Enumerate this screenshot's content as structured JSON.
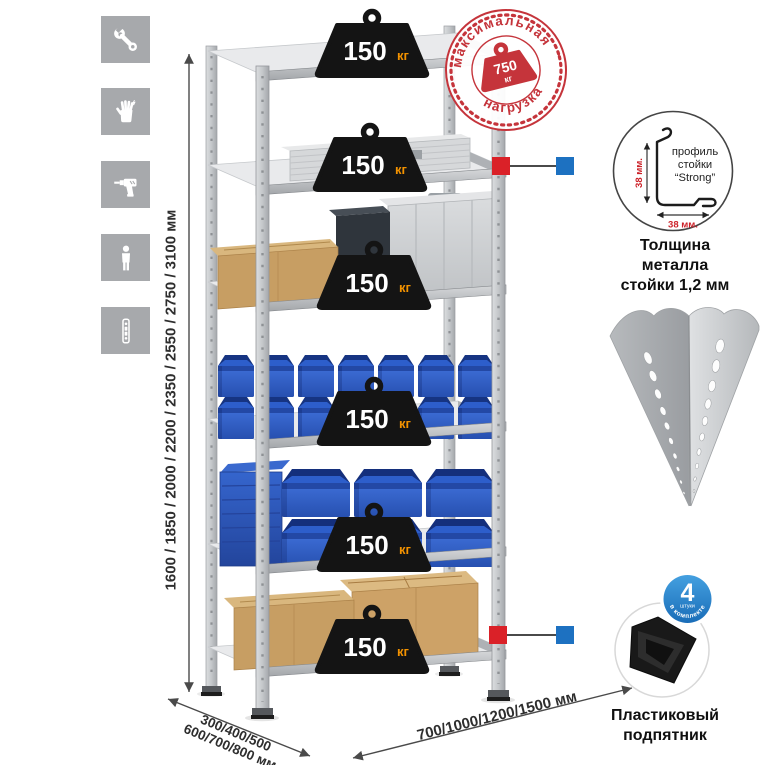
{
  "icons": {
    "items": [
      {
        "name": "wrench-icon"
      },
      {
        "name": "work-gloves-icon"
      },
      {
        "name": "power-drill-icon"
      },
      {
        "name": "assembler-person-icon"
      },
      {
        "name": "perforated-post-icon"
      }
    ]
  },
  "dimensions": {
    "height": "1600 / 1850 / 2000 / 2200 / 2350 / 2550 / 2750 / 3100 мм",
    "depth_line1": "300/400/500",
    "depth_line2": "600/700/800 мм",
    "width": "700/1000/1200/1500 мм"
  },
  "shelves": [
    {
      "load": "150",
      "unit": "кг"
    },
    {
      "load": "150",
      "unit": "кг"
    },
    {
      "load": "150",
      "unit": "кг"
    },
    {
      "load": "150",
      "unit": "кг"
    },
    {
      "load": "150",
      "unit": "кг"
    },
    {
      "load": "150",
      "unit": "кг"
    }
  ],
  "stamp": {
    "arc_top": "максимальная",
    "arc_bottom": "нагрузка",
    "value": "750",
    "unit": "кг"
  },
  "profile_detail": {
    "label_line1": "профиль",
    "label_line2": "стойки",
    "label_line3": "“Strong”",
    "dim_vertical": "38 мм.",
    "dim_horizontal": "38 мм.",
    "caption_line1": "Толщина металла",
    "caption_line2": "стойки 1,2 мм"
  },
  "foot_detail": {
    "badge_value": "4",
    "badge_sub": "штуки",
    "badge_arc": "в комплекте",
    "caption_line1": "Пластиковый",
    "caption_line2": "подпятник"
  },
  "colors": {
    "stamp_red": "#c5343b",
    "callout_red": "#da2128",
    "callout_blue": "#1d71c1",
    "badge_blue": "#2a8ad2",
    "bin_blue": "#2f5cc4",
    "weight_black": "#141414",
    "kg_orange": "#f39200",
    "metal_gray": "#c9cbce",
    "icon_gray": "#a7a9ac",
    "cardboard": "#c79e63",
    "dimension_text": "#2e2e2e"
  }
}
